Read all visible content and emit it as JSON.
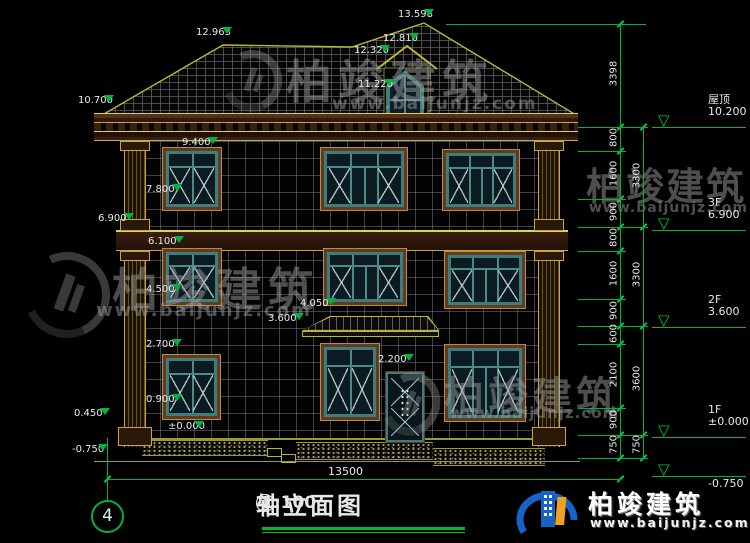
{
  "brand": {
    "name": "柏竣建筑",
    "url": "www.baijunjz.com"
  },
  "title": {
    "axis_start": "4",
    "axis_end": "1",
    "label": "轴立面图",
    "scale": "1:100",
    "separator": "—"
  },
  "grid_bubble": "4",
  "bottom_dim": "13500",
  "left_markers": [
    {
      "v": "13.598"
    },
    {
      "v": "12.963"
    },
    {
      "v": "12.810"
    },
    {
      "v": "12.320"
    },
    {
      "v": "11.220"
    },
    {
      "v": "10.700"
    },
    {
      "v": "9.400"
    },
    {
      "v": "7.800"
    },
    {
      "v": "6.900"
    },
    {
      "v": "6.100"
    },
    {
      "v": "4.500"
    },
    {
      "v": "4.050"
    },
    {
      "v": "3.600"
    },
    {
      "v": "2.700"
    },
    {
      "v": "2.200"
    },
    {
      "v": "0.900"
    },
    {
      "v": "0.450"
    },
    {
      "v": "±0.000"
    },
    {
      "v": "-0.750"
    }
  ],
  "right_levels": [
    {
      "name": "屋顶",
      "elev": "10.200"
    },
    {
      "name": "3F",
      "elev": "6.900"
    },
    {
      "name": "2F",
      "elev": "3.600"
    },
    {
      "name": "1F",
      "elev": "±0.000"
    },
    {
      "name": "",
      "elev": "-0.750"
    }
  ],
  "dim_col_inner": [
    "3398",
    "800",
    "1600",
    "900",
    "800",
    "1600",
    "900",
    "600",
    "2100",
    "900",
    "750"
  ],
  "dim_col_outer": [
    "3300",
    "3300",
    "3600",
    "750"
  ],
  "colors": {
    "dimension_green": "#00b33c",
    "outline_yellow": "#b8b832",
    "frame_teal": "#3f7d7d",
    "frame_brown": "#5f3c20"
  }
}
